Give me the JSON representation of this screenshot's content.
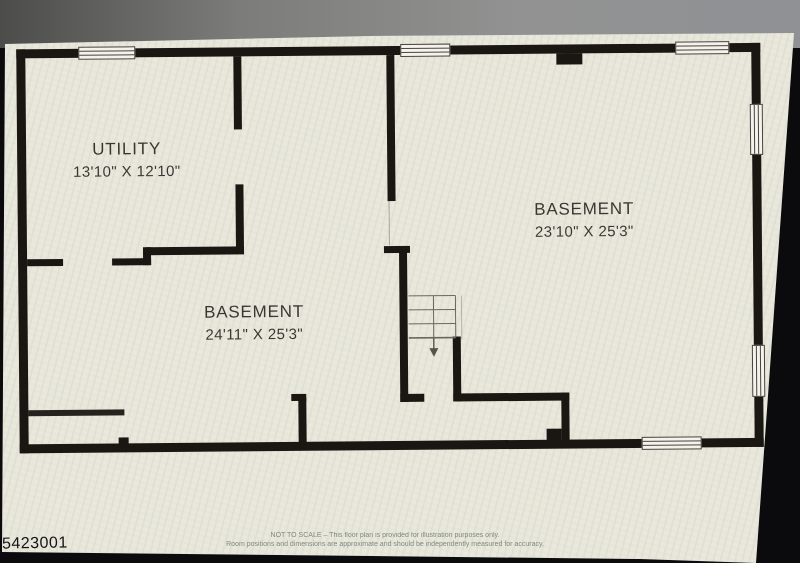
{
  "photo": {
    "watermark_id": "5423001"
  },
  "plan": {
    "rooms": [
      {
        "name": "UTILITY",
        "dimensions": "13'10\" X 12'10\""
      },
      {
        "name": "BASEMENT",
        "dimensions": "24'11\" X 25'3\""
      },
      {
        "name": "BASEMENT",
        "dimensions": "23'10\" X 25'3\""
      }
    ]
  },
  "footer": {
    "line1": "NOT TO SCALE – This floor plan is provided for illustration purposes only.",
    "line2": "Room positions and dimensions are approximate and should be independently measured for accuracy."
  },
  "colors": {
    "wall": "#1a1713",
    "paper": "#eae7db",
    "label_text": "#3a3733",
    "footer_text": "#79857c",
    "watermark_text": "#141414"
  }
}
